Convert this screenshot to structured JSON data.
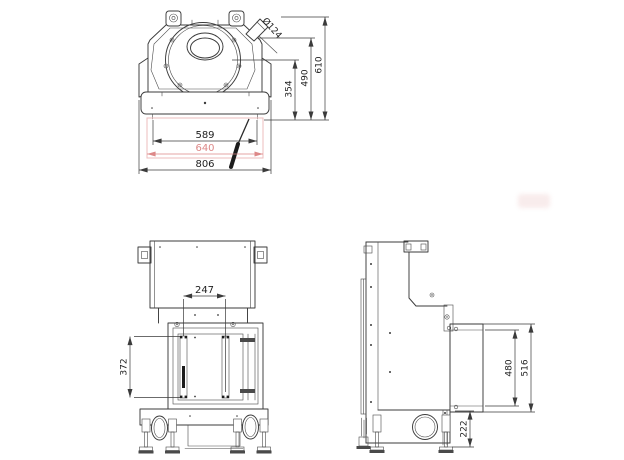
{
  "document": {
    "type": "technical-drawing",
    "colors": {
      "lines": "#3b3b3b",
      "dimension_text": "#1e1e1e",
      "highlight_red": "#dd8888",
      "glass_outline_pink": "#eebcbc",
      "watermark_pink": "#edc9c9"
    },
    "views": {
      "top_plan": {
        "dims": {
          "glass_width": "589",
          "door_width": "640",
          "overall_width": "806",
          "front_depth": "354",
          "mid_depth": "490",
          "overall_depth": "610",
          "flue_diameter": "Ø124"
        }
      },
      "front": {
        "dims": {
          "opening_width": "247",
          "opening_height": "372"
        }
      },
      "side": {
        "dims": {
          "rear_panel_inner_height": "480",
          "rear_panel_height": "516",
          "base_height": "222"
        }
      }
    }
  }
}
